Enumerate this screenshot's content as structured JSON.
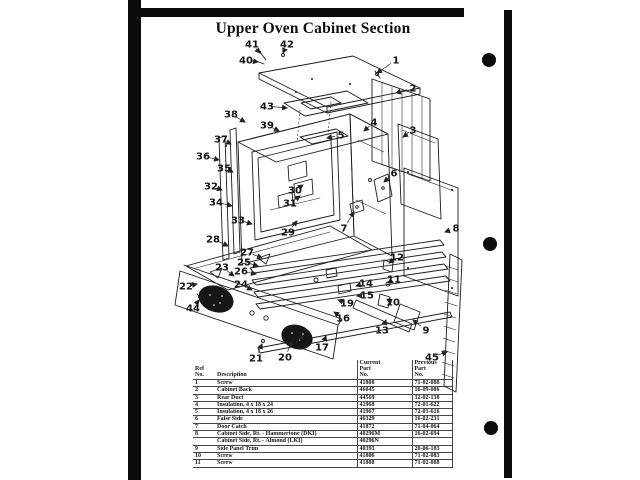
{
  "page": {
    "title": "Upper Oven Cabinet Section"
  },
  "diagram": {
    "callouts": [
      {
        "n": "41",
        "x": 252,
        "y": 44,
        "tx": 260,
        "ty": 53
      },
      {
        "n": "42",
        "x": 287,
        "y": 44,
        "tx": 283,
        "ty": 53
      },
      {
        "n": "40",
        "x": 246,
        "y": 60,
        "tx": 258,
        "ty": 62
      },
      {
        "n": "1",
        "x": 396,
        "y": 60,
        "tx": 377,
        "ty": 73
      },
      {
        "n": "2",
        "x": 413,
        "y": 88,
        "tx": 396,
        "ty": 93
      },
      {
        "n": "43",
        "x": 267,
        "y": 106,
        "tx": 287,
        "ty": 108
      },
      {
        "n": "38",
        "x": 231,
        "y": 114,
        "tx": 245,
        "ty": 122
      },
      {
        "n": "39",
        "x": 267,
        "y": 125,
        "tx": 279,
        "ty": 131
      },
      {
        "n": "4",
        "x": 374,
        "y": 122,
        "tx": 364,
        "ty": 131
      },
      {
        "n": "3",
        "x": 413,
        "y": 130,
        "tx": 403,
        "ty": 137
      },
      {
        "n": "5",
        "x": 341,
        "y": 135,
        "tx": 327,
        "ty": 138
      },
      {
        "n": "37",
        "x": 221,
        "y": 139,
        "tx": 231,
        "ty": 144
      },
      {
        "n": "36",
        "x": 203,
        "y": 156,
        "tx": 219,
        "ty": 160
      },
      {
        "n": "35",
        "x": 224,
        "y": 168,
        "tx": 233,
        "ty": 172
      },
      {
        "n": "6",
        "x": 394,
        "y": 173,
        "tx": 384,
        "ty": 182
      },
      {
        "n": "32",
        "x": 211,
        "y": 186,
        "tx": 222,
        "ty": 190
      },
      {
        "n": "30",
        "x": 295,
        "y": 190,
        "tx": 303,
        "ty": 185
      },
      {
        "n": "34",
        "x": 216,
        "y": 202,
        "tx": 232,
        "ty": 206
      },
      {
        "n": "31",
        "x": 290,
        "y": 203,
        "tx": 300,
        "ty": 196
      },
      {
        "n": "33",
        "x": 238,
        "y": 220,
        "tx": 252,
        "ty": 224
      },
      {
        "n": "7",
        "x": 344,
        "y": 228,
        "tx": 354,
        "ty": 212
      },
      {
        "n": "8",
        "x": 456,
        "y": 228,
        "tx": 445,
        "ty": 232
      },
      {
        "n": "29",
        "x": 288,
        "y": 232,
        "tx": 297,
        "ty": 221
      },
      {
        "n": "28",
        "x": 213,
        "y": 239,
        "tx": 228,
        "ty": 246
      },
      {
        "n": "27",
        "x": 247,
        "y": 252,
        "tx": 262,
        "ty": 258
      },
      {
        "n": "12",
        "x": 397,
        "y": 257,
        "tx": 389,
        "ty": 263
      },
      {
        "n": "25",
        "x": 244,
        "y": 262,
        "tx": 258,
        "ty": 266
      },
      {
        "n": "23",
        "x": 222,
        "y": 267,
        "tx": 234,
        "ty": 276
      },
      {
        "n": "26",
        "x": 241,
        "y": 271,
        "tx": 256,
        "ty": 274
      },
      {
        "n": "11",
        "x": 394,
        "y": 279,
        "tx": 388,
        "ty": 283
      },
      {
        "n": "14",
        "x": 366,
        "y": 283,
        "tx": 356,
        "ty": 286
      },
      {
        "n": "24",
        "x": 241,
        "y": 284,
        "tx": 252,
        "ty": 290
      },
      {
        "n": "22",
        "x": 186,
        "y": 286,
        "tx": 197,
        "ty": 284
      },
      {
        "n": "15",
        "x": 367,
        "y": 295,
        "tx": 357,
        "ty": 296
      },
      {
        "n": "10",
        "x": 393,
        "y": 302,
        "tx": 387,
        "ty": 300
      },
      {
        "n": "19",
        "x": 347,
        "y": 303,
        "tx": 338,
        "ty": 300
      },
      {
        "n": "44",
        "x": 193,
        "y": 308,
        "tx": 199,
        "ty": 300
      },
      {
        "n": "16",
        "x": 343,
        "y": 318,
        "tx": 334,
        "ty": 312
      },
      {
        "n": "9",
        "x": 426,
        "y": 330,
        "tx": 413,
        "ty": 320
      },
      {
        "n": "13",
        "x": 382,
        "y": 330,
        "tx": 386,
        "ty": 320
      },
      {
        "n": "18",
        "x": 299,
        "y": 343,
        "tx": 303,
        "ty": 336
      },
      {
        "n": "17",
        "x": 322,
        "y": 347,
        "tx": 326,
        "ty": 336
      },
      {
        "n": "45",
        "x": 432,
        "y": 357,
        "tx": 447,
        "ty": 352
      },
      {
        "n": "21",
        "x": 256,
        "y": 358,
        "tx": 262,
        "ty": 344
      },
      {
        "n": "20",
        "x": 285,
        "y": 357,
        "tx": 292,
        "ty": 342
      }
    ]
  },
  "table": {
    "columns": [
      {
        "id": "ref",
        "lines": [
          "Ref",
          "No."
        ]
      },
      {
        "id": "desc",
        "lines": [
          "Description"
        ]
      },
      {
        "id": "current",
        "lines": [
          "Current",
          "Part",
          "No."
        ]
      },
      {
        "id": "previous",
        "lines": [
          "Previous",
          "Part",
          "No."
        ]
      }
    ],
    "rows": [
      {
        "ref": "1",
        "desc": "Screw",
        "current": "41808",
        "previous": "71-02-088"
      },
      {
        "ref": "2",
        "desc": "Cabinet Back",
        "current": "46045",
        "previous": "16-09-086"
      },
      {
        "ref": "3",
        "desc": "Rear Duct",
        "current": "44569",
        "previous": "32-02-138"
      },
      {
        "ref": "4",
        "desc": "Insulation, 4 x 18 x 24",
        "current": "41968",
        "previous": "72-01-622"
      },
      {
        "ref": "5",
        "desc": "Insulation, 4 x 18 x 26",
        "current": "41967",
        "previous": "72-01-616"
      },
      {
        "ref": "6",
        "desc": "False Side",
        "current": "46329",
        "previous": "16-02-231"
      },
      {
        "ref": "7",
        "desc": "Door Catch",
        "current": "41872",
        "previous": "71-04-064"
      },
      {
        "ref": "8",
        "desc": "Cabinet Side, Rt. - Hammertone (DKI)",
        "current": "40296M",
        "previous": "16-02-694"
      },
      {
        "ref": "",
        "desc": "Cabinet Side, Rt. - Almond (LKI)",
        "current": "40296N",
        "previous": ""
      },
      {
        "ref": "9",
        "desc": "Side Panel Trim",
        "current": "40393",
        "previous": "20-06-183"
      },
      {
        "ref": "10",
        "desc": "Screw",
        "current": "41806",
        "previous": "71-02-083"
      },
      {
        "ref": "11",
        "desc": "Screw",
        "current": "41808",
        "previous": "71-02-088"
      }
    ]
  }
}
